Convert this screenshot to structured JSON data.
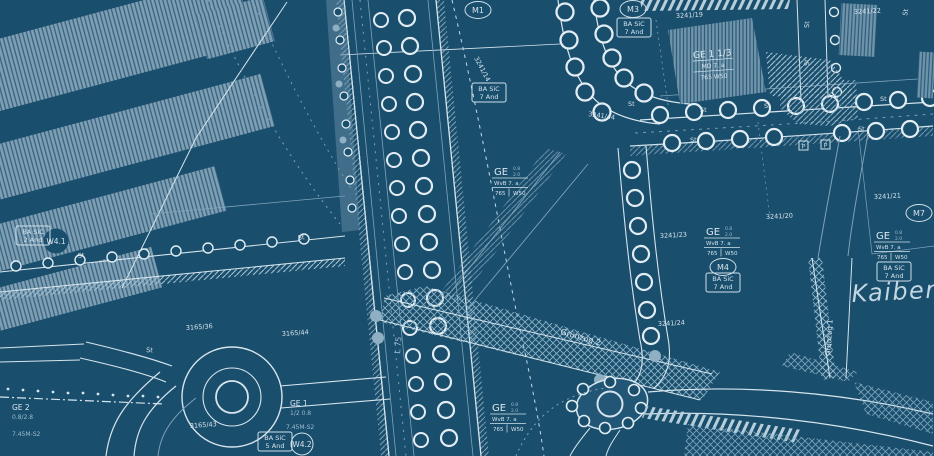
{
  "map": {
    "colors": {
      "background": "#1a4e6d",
      "line_bright": "#dce9f0",
      "line_muted": "#7fa3b8",
      "building_fill": "#7fa0b4",
      "text_bright": "#d5e3ec",
      "text_muted": "#9dbccd"
    },
    "zone_markers": {
      "m1": "M1",
      "m3": "M3",
      "m4": "M4",
      "m7": "M7",
      "w41": "W4.1",
      "w42": "W4.2"
    },
    "restriction_boxes": {
      "ba_sic_7": {
        "line1": "BA SiC",
        "line2": "7 And"
      },
      "ba_sic_2": {
        "line1": "BA SiC",
        "line2": "2 And"
      },
      "ba_sic_5": {
        "line1": "BA SiC",
        "line2": "5 And"
      }
    },
    "ge_schablone": {
      "main": "GE",
      "sup_top": "0.8",
      "sup_bottom": "2.0",
      "mid": "WvB 7. a",
      "bottom_left": "765",
      "bottom_right": "W50"
    },
    "ge_building_label": {
      "line1": "GE 1 1/3",
      "line2": "MD 7. a",
      "line3": "765 W50"
    },
    "ge1_label": {
      "line1": "GE 1",
      "line2": "1/2 0.8",
      "line3": "7.45M-S2"
    },
    "ge2_label": {
      "line1": "GE 2",
      "line2": "0.8/2.8",
      "line3": "7.45M-S2"
    },
    "street_names": {
      "kaiber": "Kaiber",
      "gruenzug1": "Grünzug 1",
      "gruenzug2": "Grünzug 2",
      "l75": "L 75",
      "tree_label": "St",
      "parking": "P"
    },
    "parcel_numbers": {
      "p1": "3241/19",
      "p2": "3241/22",
      "p3": "3241/14",
      "p4": "3241/20",
      "p5": "3241/23",
      "p6": "3241/24",
      "p7": "3241/21",
      "p8": "3241/44",
      "p9": "3165/36",
      "p10": "3165/44",
      "p11": "3165/43"
    }
  }
}
